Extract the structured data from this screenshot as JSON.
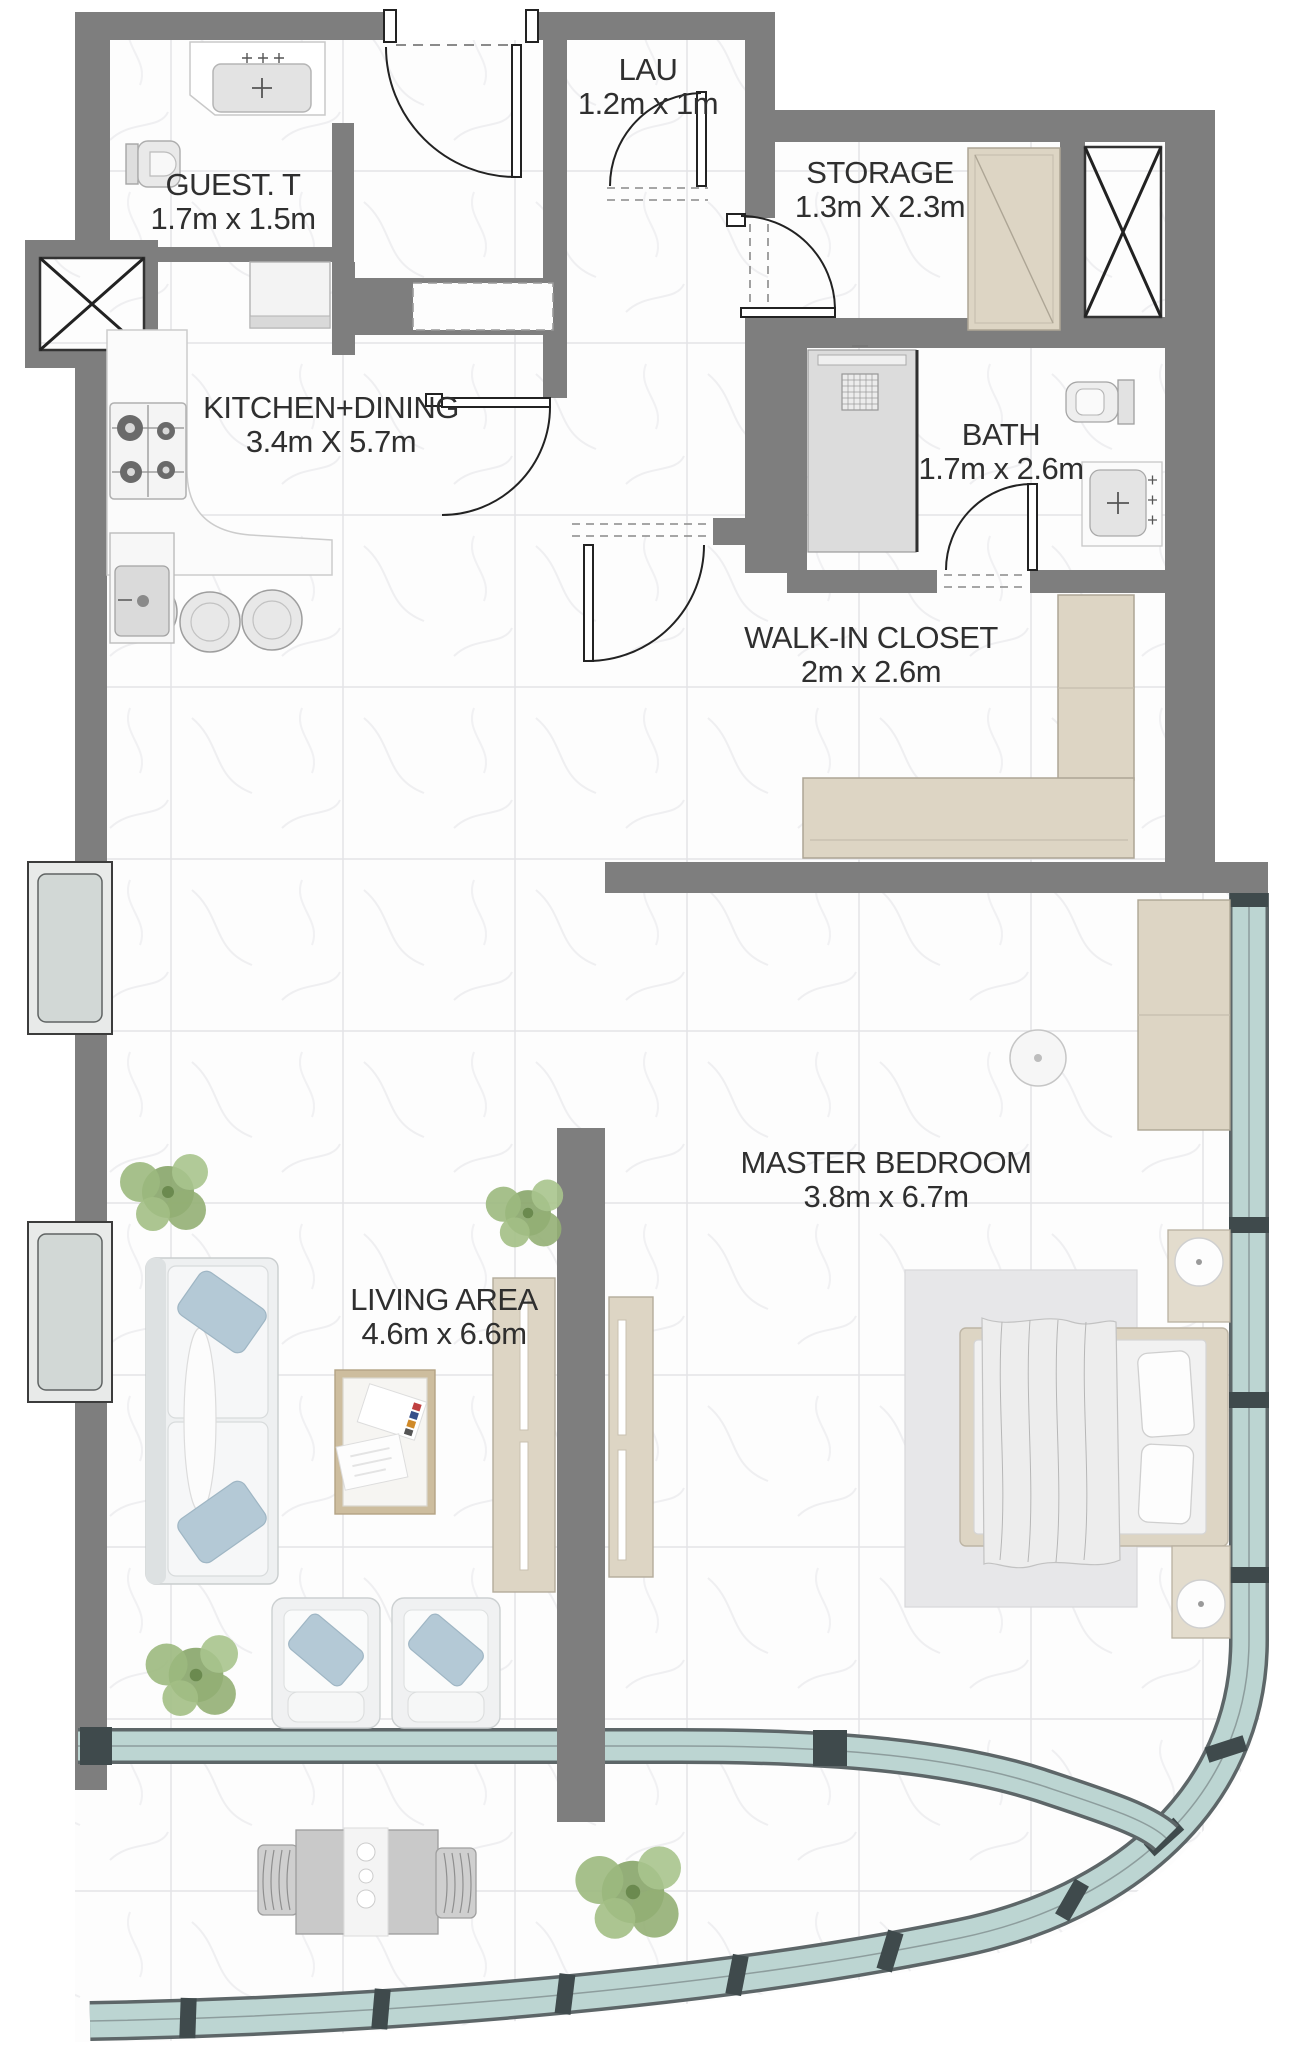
{
  "rooms": [
    {
      "id": "guest-toilet",
      "name": "GUEST. T",
      "dims": "1.7m x 1.5m"
    },
    {
      "id": "laundry",
      "name": "LAU",
      "dims": "1.2m x 1m"
    },
    {
      "id": "storage",
      "name": "STORAGE",
      "dims": "1.3m X 2.3m"
    },
    {
      "id": "kitchen-dining",
      "name": "KITCHEN+DINING",
      "dims": "3.4m X 5.7m"
    },
    {
      "id": "bath",
      "name": "BATH",
      "dims": "1.7m x 2.6m"
    },
    {
      "id": "walk-in-closet",
      "name": "WALK-IN CLOSET",
      "dims": "2m x 2.6m"
    },
    {
      "id": "master-bedroom",
      "name": "MASTER BEDROOM",
      "dims": "3.8m x 6.7m"
    },
    {
      "id": "living-area",
      "name": "LIVING AREA",
      "dims": "4.6m x 6.6m"
    }
  ],
  "colors": {
    "wall": "#7e7e7e",
    "floor": "#ffffff",
    "tile_line": "#e3e3e6",
    "glass": "#bcd5d2",
    "glass_dark": "#3f4a4c",
    "furniture": "#ddd5c4",
    "furniture_edge": "#ada595",
    "fixture_fill": "#e8e8e8",
    "fixture_edge": "#a8a8a8",
    "accent_blue": "#b4c9d6",
    "plant": "#8fae71",
    "text": "#2f2f2f",
    "door_line": "#222222"
  }
}
